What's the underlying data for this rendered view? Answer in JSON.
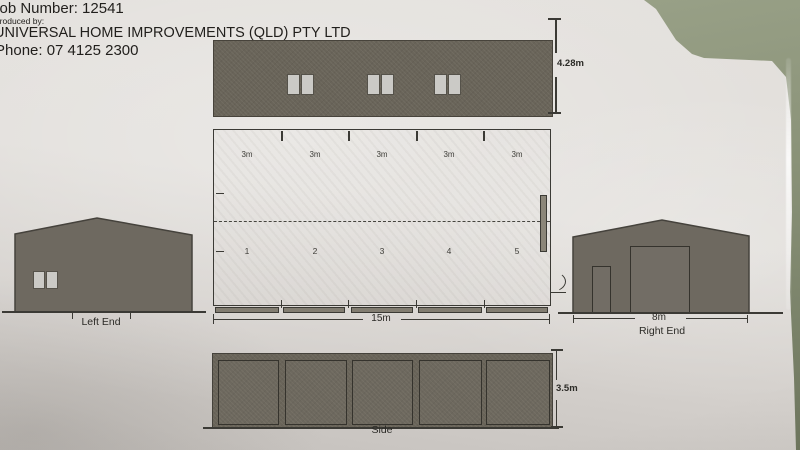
{
  "colors": {
    "surface": "#8d957b",
    "paper": "#dedbd7",
    "building_fill": "#696459",
    "line": "#3b3a35"
  },
  "header": {
    "job_number": "Job Number: 12541",
    "produced_by": "Produced by:",
    "company": "UNIVERSAL HOME IMPROVEMENTS (QLD) PTY LTD",
    "phone": "Phone: 07 4125 2300"
  },
  "plan": {
    "front_elevation": {
      "height_dim": "4.28m",
      "window_pairs": 3
    },
    "floor_plan": {
      "bay_dims": [
        "3m",
        "3m",
        "3m",
        "3m",
        "3m"
      ],
      "bay_numbers": [
        "1",
        "2",
        "3",
        "4",
        "5"
      ],
      "width_dim": "15m"
    },
    "left_end": {
      "label": "Left End"
    },
    "right_end": {
      "label": "Right End",
      "width_dim": "8m"
    },
    "side": {
      "label": "Side",
      "height_dim": "3.5m"
    }
  }
}
